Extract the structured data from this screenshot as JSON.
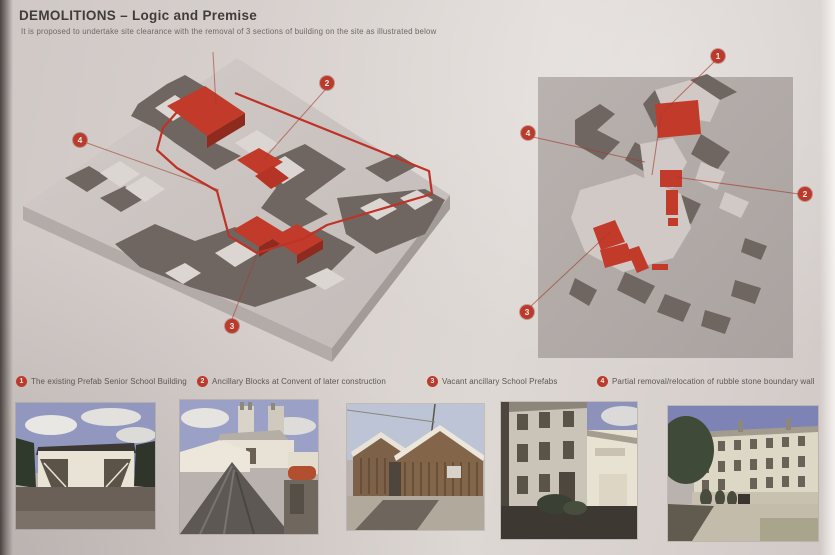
{
  "page": {
    "title": "DEMOLITIONS – Logic and Premise",
    "subtitle": "It is proposed to undertake site clearance with the removal of 3 sections of building on the site as illustrated below",
    "accent_color": "#bc3a2b"
  },
  "models": {
    "left": {
      "name": "isometric site massing model with demolition areas in red",
      "markers": [
        {
          "num": "2"
        },
        {
          "num": "4"
        },
        {
          "num": "3"
        }
      ]
    },
    "right": {
      "name": "aerial site massing model with demolition areas in red",
      "markers": [
        {
          "num": "1"
        },
        {
          "num": "4"
        },
        {
          "num": "2"
        },
        {
          "num": "3"
        }
      ]
    }
  },
  "legend": [
    {
      "num": "1",
      "label": "The existing Prefab Senior School Building"
    },
    {
      "num": "2",
      "label": "Ancillary Blocks at Convent of later construction"
    },
    {
      "num": "3",
      "label": "Vacant ancillary School Prefabs"
    },
    {
      "num": "4",
      "label": "Partial removal/relocation of rubble stone boundary wall"
    }
  ],
  "photos": [
    {
      "name": "prefab-senior-school-photo"
    },
    {
      "name": "convent-ancillary-blocks-photo"
    },
    {
      "name": "school-prefabs-photo"
    },
    {
      "name": "convent-yard-photo"
    },
    {
      "name": "convent-boundary-wall-photo"
    }
  ]
}
